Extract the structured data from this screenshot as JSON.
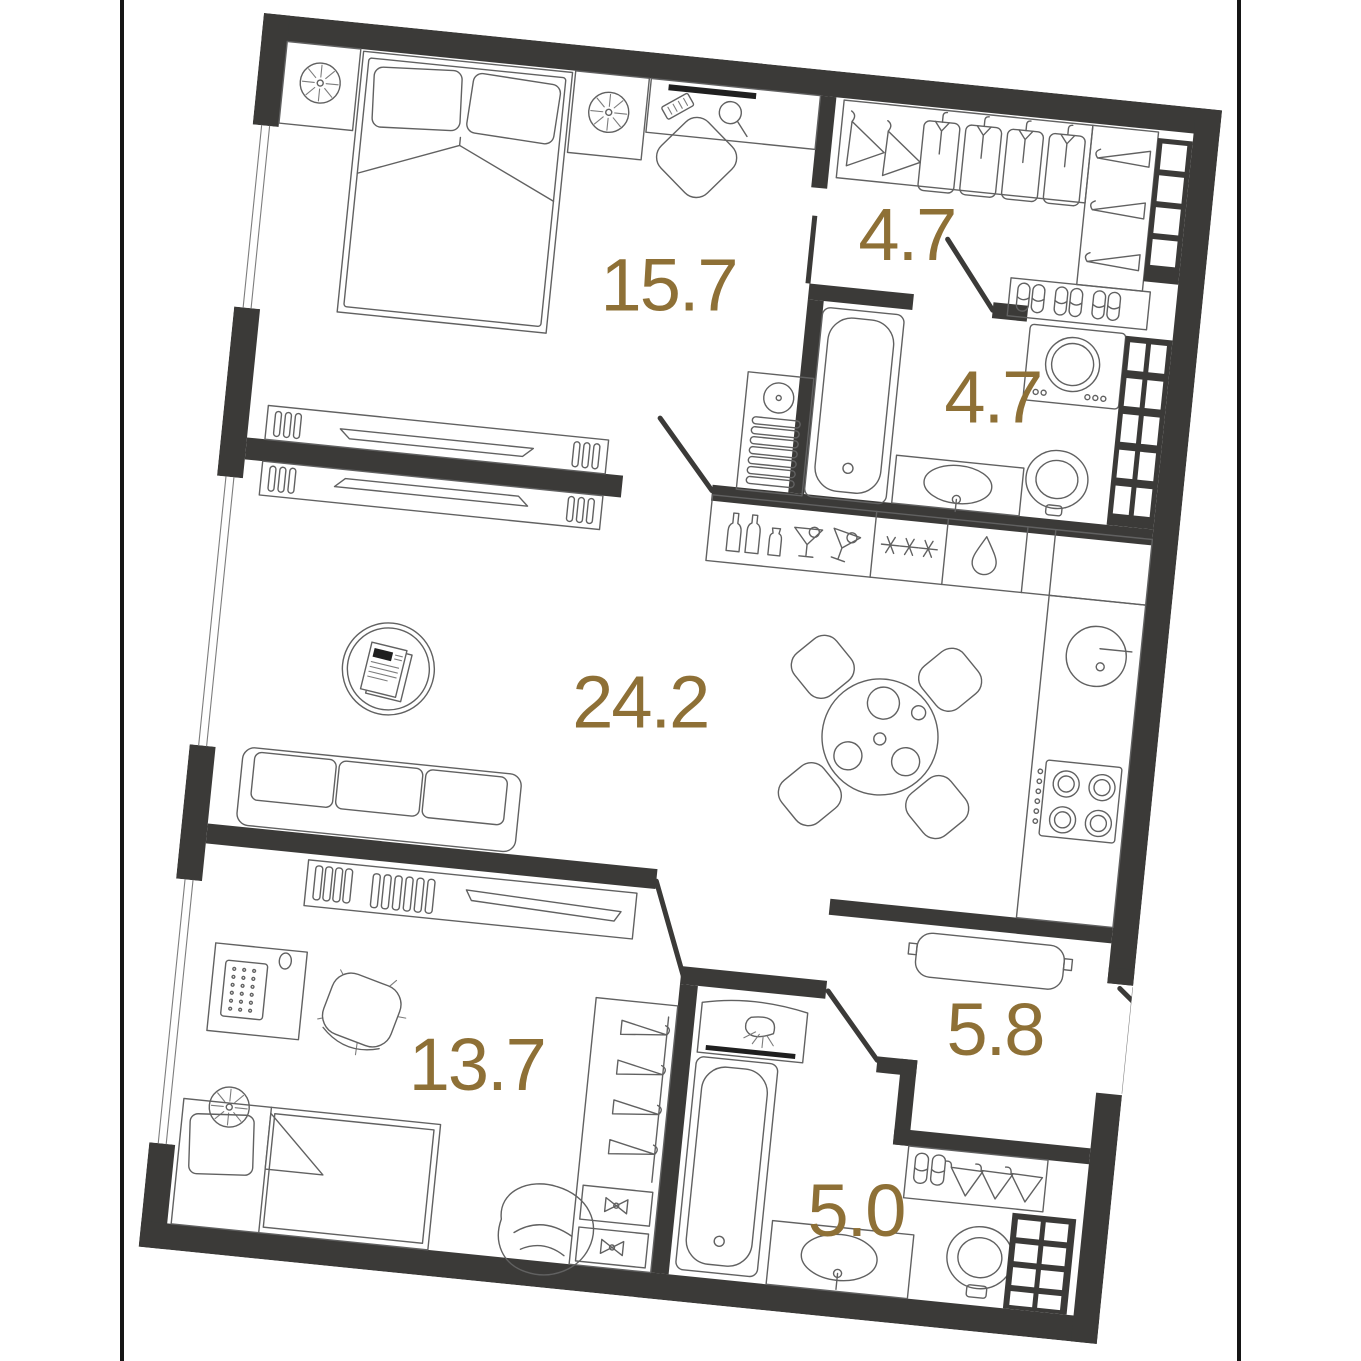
{
  "page": {
    "background": "#ffffff",
    "frame_rule_color": "#161616"
  },
  "plan": {
    "type": "apartment-floor-plan",
    "rotation_deg": 5.8,
    "wall_color": "#3b3a38",
    "furniture_line_color": "#616161",
    "label_color": "#8e7036",
    "rooms": [
      {
        "name": "bedroom",
        "area": "15.7"
      },
      {
        "name": "dressing-room",
        "area": "4.7"
      },
      {
        "name": "bathroom",
        "area": "4.7"
      },
      {
        "name": "living-kitchen",
        "area": "24.2"
      },
      {
        "name": "bedroom-2",
        "area": "13.7"
      },
      {
        "name": "hallway",
        "area": "5.8"
      },
      {
        "name": "bathroom-2",
        "area": "5.0"
      }
    ],
    "icons": [
      "fan-icon",
      "bed-icon",
      "pillow-icon",
      "nightstand-icon",
      "mirror-icon",
      "comb-icon",
      "stool-icon",
      "tv-console-icon",
      "coffee-table-icon",
      "newspaper-icon",
      "sofa-icon",
      "dining-table-icon",
      "chair-icon",
      "bar-bottles-icon",
      "cocktail-icon",
      "snowflake-icon",
      "water-drop-icon",
      "kitchen-sink-icon",
      "cooktop-icon",
      "hanger-icon",
      "shirt-icon",
      "slippers-icon",
      "shoe-grid-icon",
      "washing-machine-icon",
      "bathtub-icon",
      "washbasin-icon",
      "toilet-icon",
      "towel-grid-icon",
      "desk-icon",
      "keyboard-icon",
      "office-chair-icon",
      "single-bed-icon",
      "bean-bag-icon",
      "wardrobe-icon",
      "bench-icon",
      "shower-panel-icon",
      "door-leaf",
      "window"
    ]
  }
}
